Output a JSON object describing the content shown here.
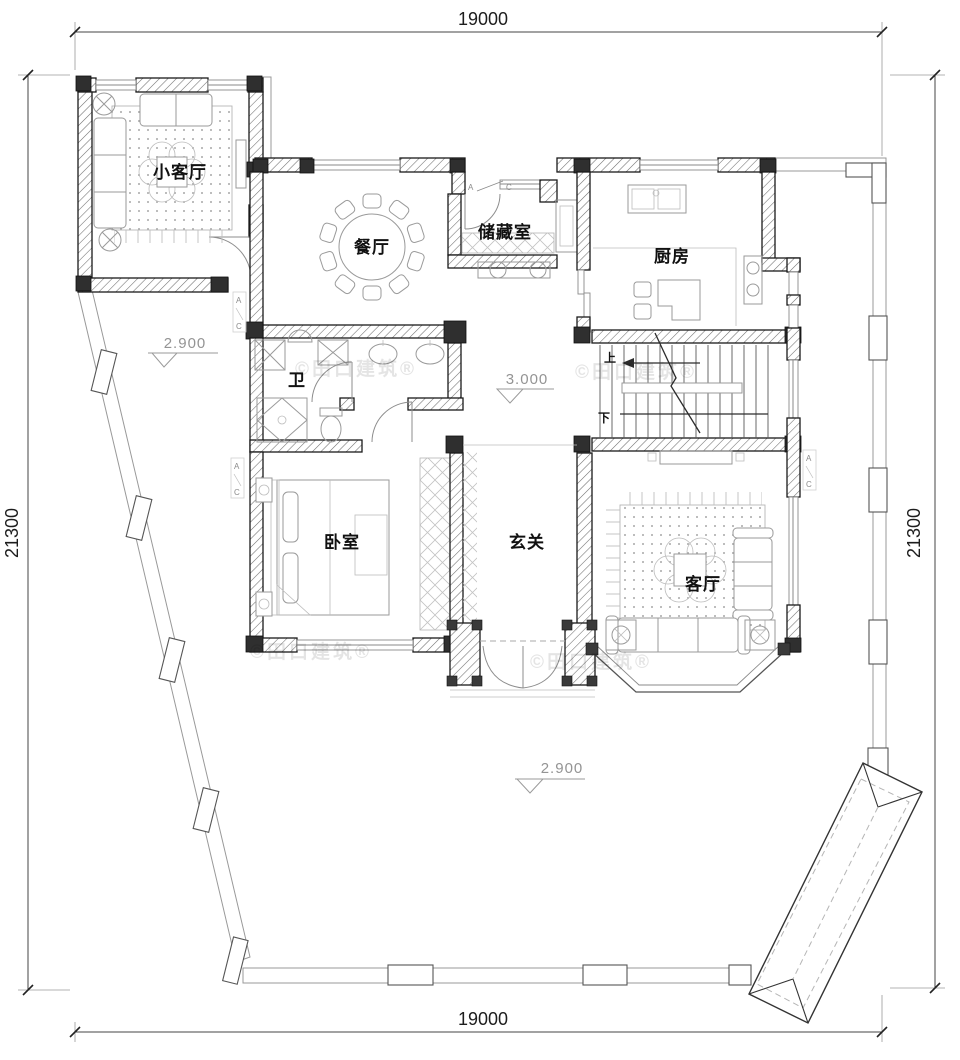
{
  "drawing": {
    "type": "residential floor plan",
    "dimensions": {
      "width_top": "19000",
      "width_bottom": "19000",
      "height_left": "21300",
      "height_right": "21300"
    },
    "rooms": {
      "small_living": "小客厅",
      "dining": "餐厅",
      "storage": "储藏室",
      "kitchen": "厨房",
      "bath": "卫",
      "bedroom": "卧室",
      "foyer": "玄关",
      "living": "客厅"
    },
    "elevations": {
      "courtyard_left": "2.900",
      "indoor": "3.000",
      "courtyard_bottom": "2.900"
    },
    "stairs": {
      "up": "上",
      "down": "下"
    },
    "section_marker": {
      "a": "A",
      "c": "C"
    },
    "watermark": "©田口建筑®",
    "colors": {
      "wall": "#1a1a1a",
      "column": "#2f2f2f",
      "furniture": "#9a9a9a",
      "dimension": "#1d1d1d",
      "elevation": "#949494",
      "boundary": "#999999",
      "watermark_opacity": "0.10"
    }
  }
}
